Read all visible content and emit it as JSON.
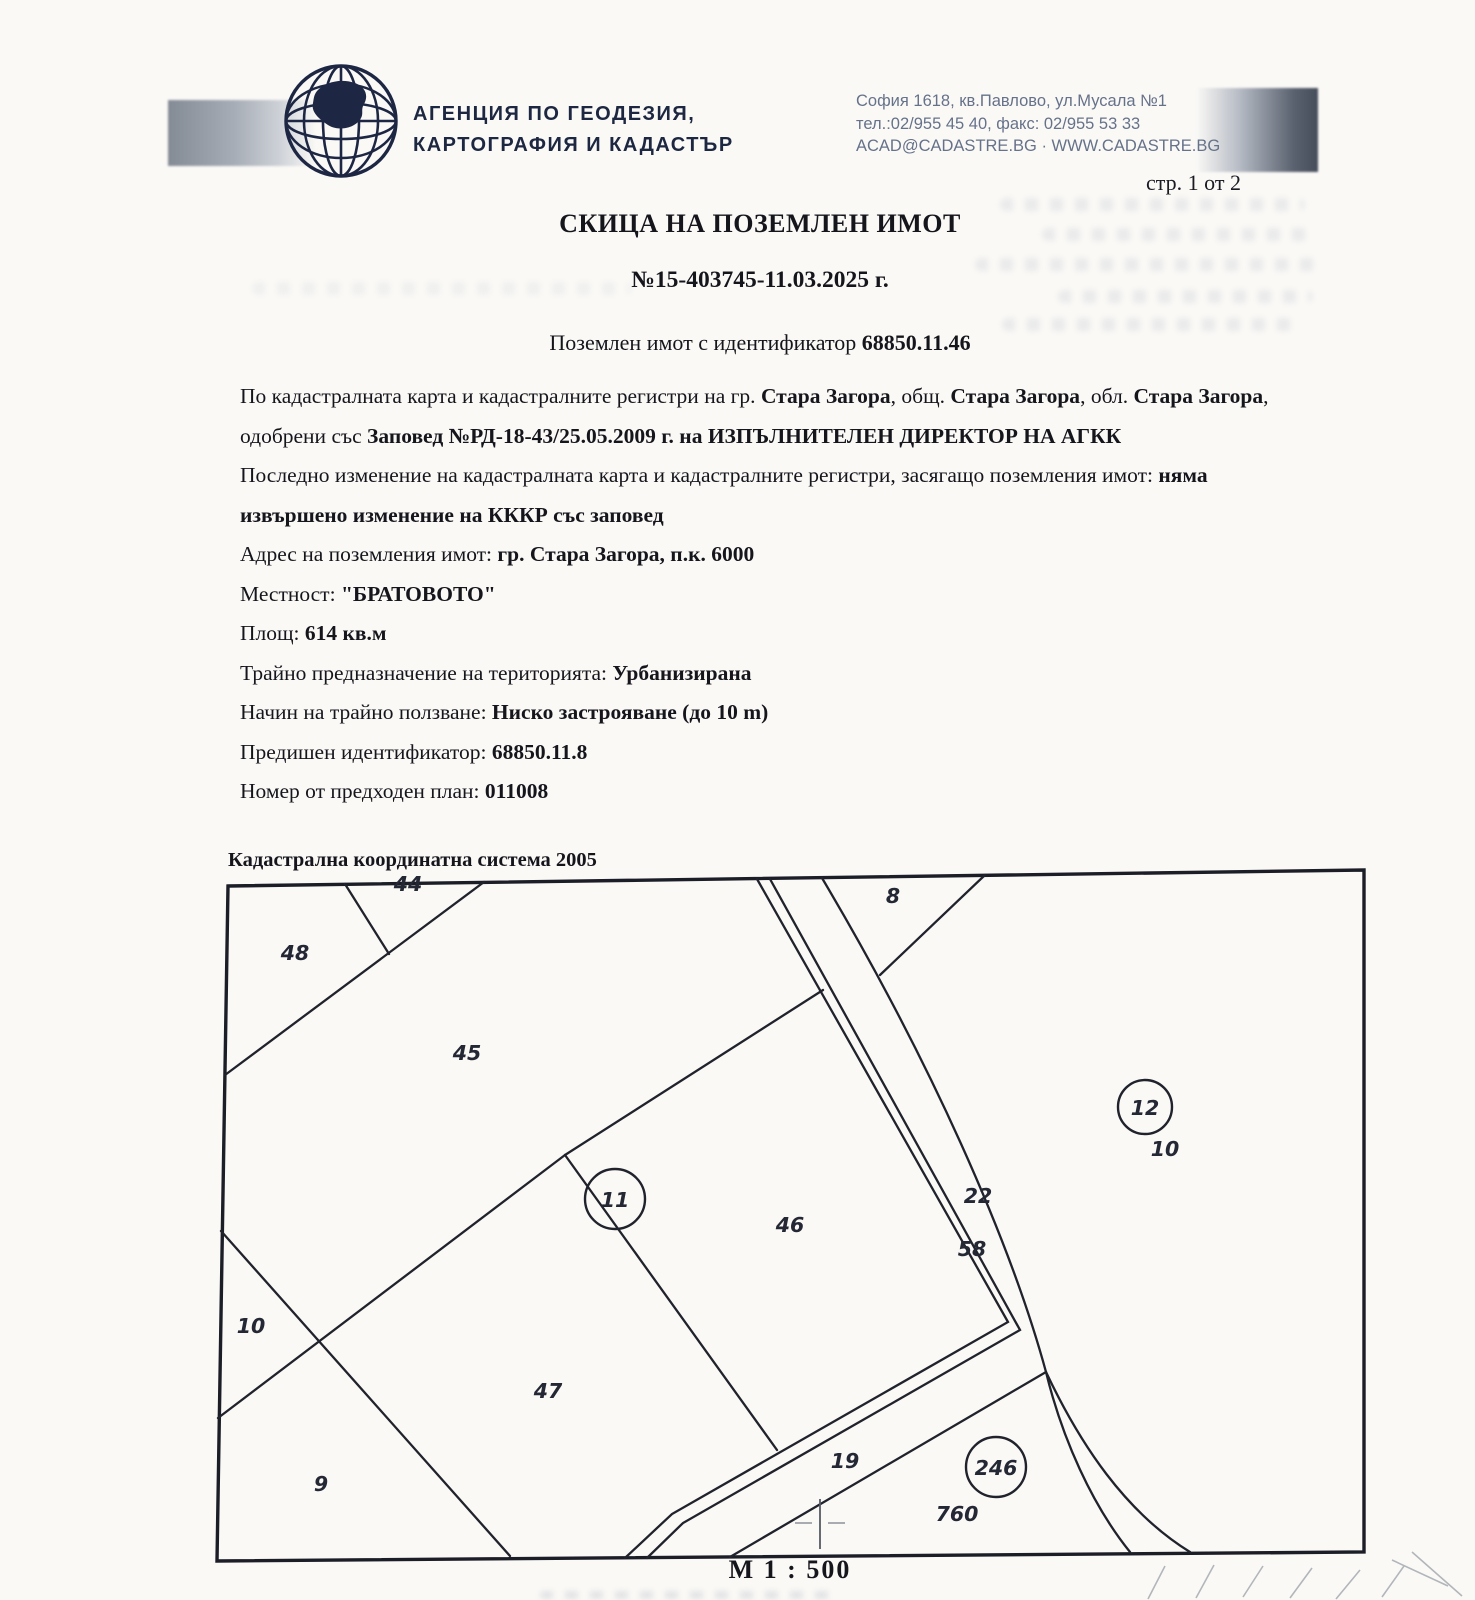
{
  "header": {
    "agency_line1": "АГЕНЦИЯ ПО ГЕОДЕЗИЯ,",
    "agency_line2": "КАРТОГРАФИЯ И КАДАСТЪР",
    "contact_line1": "София 1618, кв.Павлово, ул.Мусала №1",
    "contact_line2": "тел.:02/955 45 40, факс: 02/955 53 33",
    "contact_line3": "ACAD@CADASTRE.BG · WWW.CADASTRE.BG",
    "page_indicator": "стр. 1 от 2"
  },
  "document": {
    "title": "СКИЦА НА ПОЗЕМЛЕН ИМОТ",
    "number": "№15-403745-11.03.2025 г.",
    "id_line": {
      "label": "Поземлен имот с идентификатор ",
      "value": "68850.11.46"
    },
    "paragraph1": [
      {
        "text": "По кадастралната карта и кадастралните регистри на гр. ",
        "bold": false
      },
      {
        "text": "Стара Загора",
        "bold": true
      },
      {
        "text": ", общ. ",
        "bold": false
      },
      {
        "text": "Стара Загора",
        "bold": true
      },
      {
        "text": ", обл. ",
        "bold": false
      },
      {
        "text": "Стара Загора",
        "bold": true
      },
      {
        "text": ", одобрени със ",
        "bold": false
      },
      {
        "text": "Заповед №РД-18-43/25.05.2009 г. на ИЗПЪЛНИТЕЛЕН ДИРЕКТОР НА АГКК",
        "bold": true
      }
    ],
    "paragraph2": [
      {
        "text": "Последно изменение на кадастралната карта и кадастралните регистри, засягащо поземления имот: ",
        "bold": false
      },
      {
        "text": "няма извършено изменение на КККР със заповед",
        "bold": true
      }
    ],
    "info_lines": [
      {
        "label": "Адрес на поземления имот: ",
        "value": "гр. Стара Загора, п.к. 6000"
      },
      {
        "label": "Местност: ",
        "value": "\"БРАТОВОТО\""
      },
      {
        "label": "Площ: ",
        "value": "614 кв.м"
      },
      {
        "label": "Трайно предназначение на територията: ",
        "value": "Урбанизирана"
      },
      {
        "label": "Начин на трайно ползване: ",
        "value": "Ниско застрояване (до 10 m)"
      },
      {
        "label": "Предишен идентификатор: ",
        "value": "68850.11.8"
      },
      {
        "label": "Номер от предходен план: ",
        "value": "011008"
      }
    ],
    "coordinate_system": "Кадастрална координатна система 2005"
  },
  "map": {
    "scale_label": "М 1 : 500",
    "labels": [
      {
        "text": "44"
      },
      {
        "text": "48"
      },
      {
        "text": "45"
      },
      {
        "text": "8"
      },
      {
        "text": "22"
      },
      {
        "text": "58"
      },
      {
        "text": "46"
      },
      {
        "text": "10"
      },
      {
        "text": "10"
      },
      {
        "text": "47"
      },
      {
        "text": "9"
      },
      {
        "text": "19"
      },
      {
        "text": "760"
      }
    ],
    "circled_labels": [
      {
        "text": "11"
      },
      {
        "text": "12"
      },
      {
        "text": "246"
      }
    ]
  }
}
